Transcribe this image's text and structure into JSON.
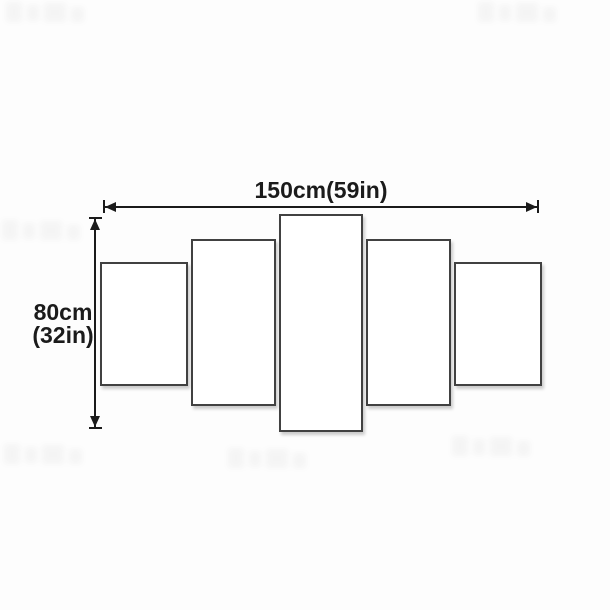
{
  "diagram": {
    "panel_count": 5,
    "width_label": "150cm(59in)",
    "height_label_line1": "80cm",
    "height_label_line2": "(32in)",
    "colors": {
      "line": "#1b1b1b",
      "panel_border": "#414141",
      "panel_fill": "#ffffff",
      "background": "#fdfdfd"
    }
  }
}
